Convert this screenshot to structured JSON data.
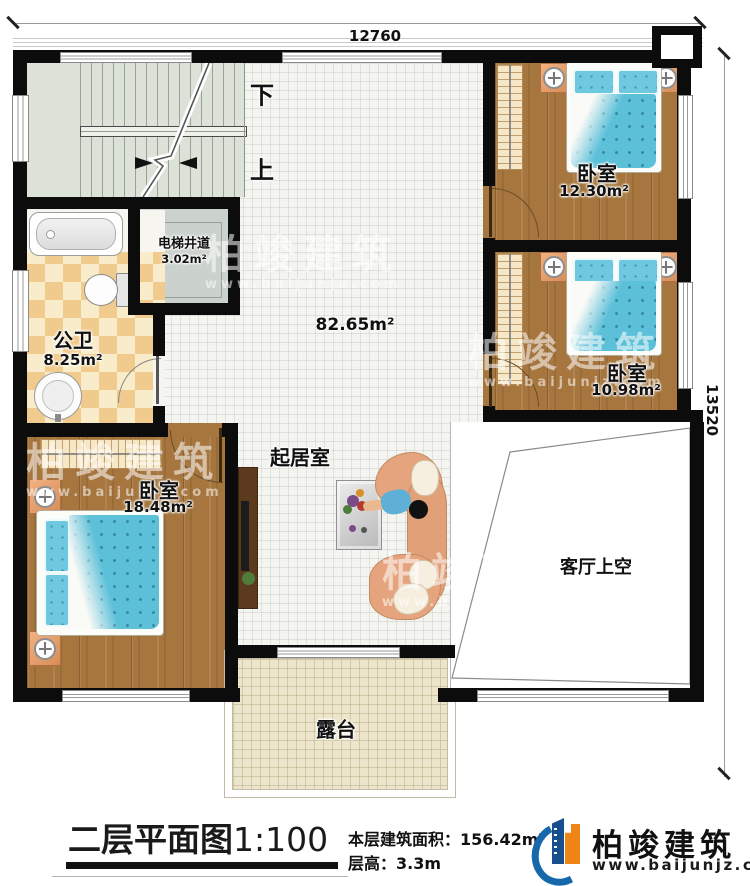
{
  "dimensions": {
    "width": "12760",
    "height": "13520"
  },
  "stairs": {
    "down": "下",
    "up": "上"
  },
  "rooms": {
    "bedroom_top": {
      "name": "卧室",
      "area": "12.30m²"
    },
    "bedroom_mid": {
      "name": "卧室",
      "area": "10.98m²"
    },
    "bedroom_left": {
      "name": "卧室",
      "area": "18.48m²"
    },
    "bathroom": {
      "name": "公卫",
      "area": "8.25m²"
    },
    "elevator": {
      "name": "电梯井道",
      "area": "3.02m²"
    },
    "living": {
      "name": "起居室",
      "area": "82.65m²"
    },
    "void": {
      "name": "客厅上空"
    },
    "terrace": {
      "name": "露台"
    }
  },
  "titleblock": {
    "title": "二层平面图",
    "scale": "1:100",
    "area_label": "本层建筑面积：",
    "area_value": "156.42m²",
    "height_label": "层高：",
    "height_value": "3.3m"
  },
  "brand": {
    "name": "柏竣建筑",
    "url": "www.baijunjz.com"
  },
  "watermark": {
    "name": "柏竣建筑",
    "url": "www.baijunjz.com"
  },
  "colors": {
    "wall": "#0c0c0c",
    "wood": "#a6763e",
    "bed_blue": "#5cc0d9",
    "brand_blue": "#1668ab",
    "brand_orange": "#f08517"
  }
}
